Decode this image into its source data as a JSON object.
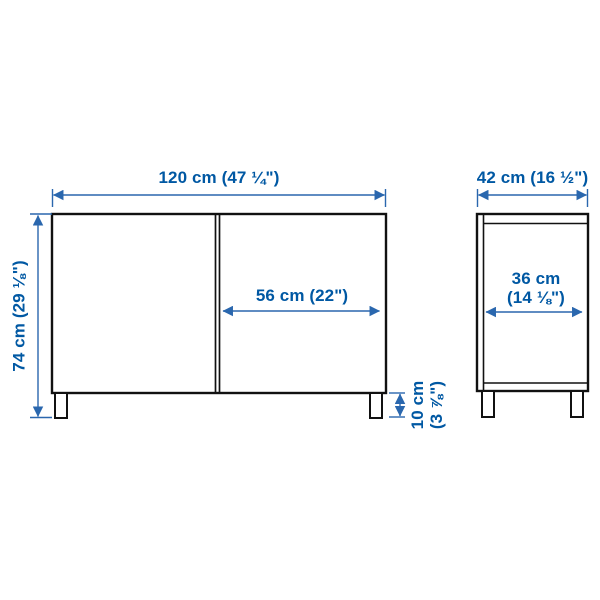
{
  "diagram": {
    "description_labels": {
      "width_front": "120 cm (47 ¼\")",
      "height_total": "74 cm (29 ⅛\")",
      "door_width": "56 cm (22\")",
      "leg_height_line1": "10 cm",
      "leg_height_line2": "(3 ⅞\")",
      "depth_top": "42 cm (16 ½\")",
      "depth_inner_line1": "36 cm",
      "depth_inner_line2": "(14 ⅛\")"
    },
    "colors": {
      "dimension_blue": "#0058a3",
      "outline_black": "#111111",
      "background": "#ffffff"
    }
  }
}
